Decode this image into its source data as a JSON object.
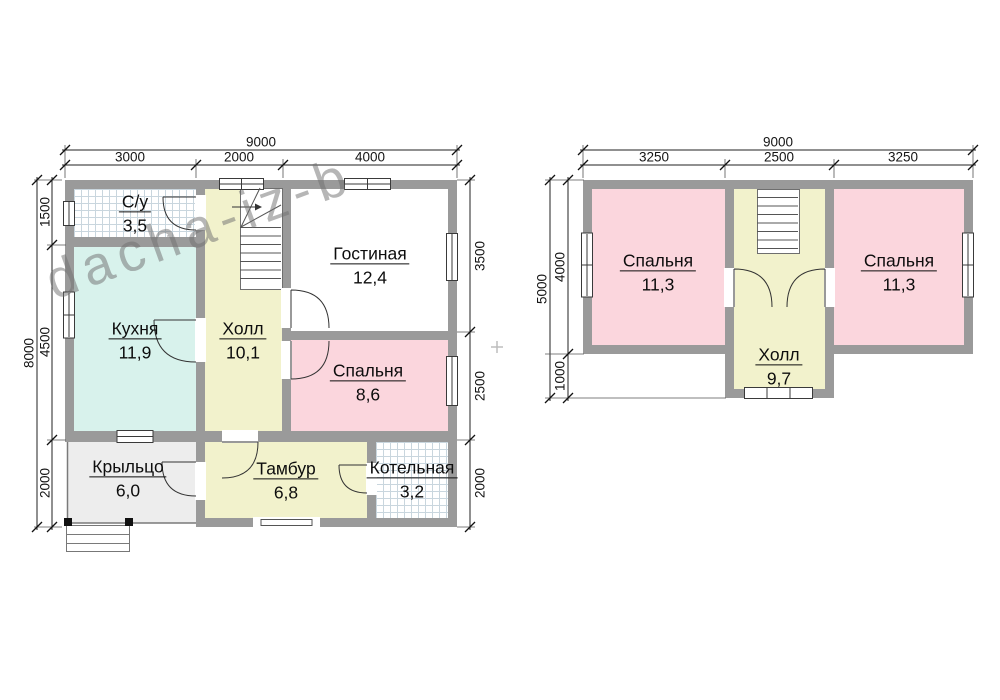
{
  "watermark": {
    "text": "dacha-iz-b"
  },
  "colors": {
    "wall": "#9a9a9a",
    "kitchen_fill": "#d8f2ec",
    "hall_fill": "#f2f2cc",
    "bedroom_fill": "#fbd6dd",
    "porch_fill": "#ededed",
    "tile_line": "#c9d6de",
    "line": "#222222"
  },
  "floor1": {
    "rooms": [
      {
        "name": "С/у",
        "area": "3,5"
      },
      {
        "name": "Кухня",
        "area": "11,9"
      },
      {
        "name": "Холл",
        "area": "10,1"
      },
      {
        "name": "Гостиная",
        "area": "12,4"
      },
      {
        "name": "Спальня",
        "area": "8,6"
      },
      {
        "name": "Крыльцо",
        "area": "6,0"
      },
      {
        "name": "Тамбур",
        "area": "6,8"
      },
      {
        "name": "Котельная",
        "area": "3,2"
      }
    ],
    "dims": {
      "top_total": "9000",
      "top": [
        "3000",
        "2000",
        "4000"
      ],
      "left_total": "8000",
      "left": [
        "1500",
        "4500",
        "2000"
      ],
      "right": [
        "3500",
        "2500",
        "2000"
      ]
    }
  },
  "floor2": {
    "rooms": [
      {
        "name": "Спальня",
        "area": "11,3"
      },
      {
        "name": "Холл",
        "area": "9,7"
      },
      {
        "name": "Спальня",
        "area": "11,3"
      }
    ],
    "dims": {
      "top_total": "9000",
      "top": [
        "3250",
        "2500",
        "3250"
      ],
      "left_total": "5000",
      "left": [
        "4000",
        "1000"
      ]
    }
  }
}
